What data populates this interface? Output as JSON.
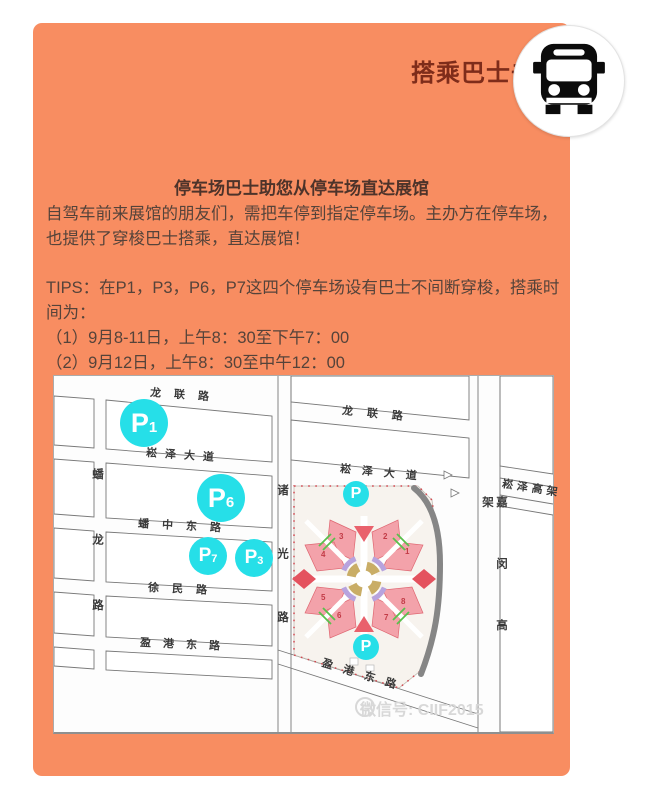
{
  "card": {
    "title": "搭乘巴士去展馆"
  },
  "intro": {
    "heading": "停车场巴士助您从停车场直达展馆",
    "line1": "自驾车前来展馆的朋友们，需把车停到指定停车场。主办方在停车场，",
    "line2": "也提供了穿梭巴士搭乘，直达展馆！"
  },
  "tips": {
    "line1": "TIPS：在P1，P3，P6，P7这四个停车场设有巴士不间断穿梭，搭乘时",
    "line2": "间为：",
    "item1": "（1）9月8-11日，上午8：30至下午7：00",
    "item2": "（2）9月12日，上午8：30至中午12：00"
  },
  "map": {
    "roads": {
      "longlian_w": "龙联路",
      "longlian_e": "龙联路",
      "songze_ave_w": "崧泽大道",
      "songze_ave_e": "崧泽大道",
      "panzhong_rd": "蟠中东路",
      "xumin_rd": "徐民路",
      "yinggang_w": "盈港东路",
      "yinggang_diag": "盈港东路",
      "songze_viaduct": "崧泽高架",
      "panlong_rd": "蟠龙路",
      "zhuguang_rd": "诸光路",
      "jiamin_viaduct": "嘉闵高架"
    },
    "parking": {
      "p1": {
        "p": "P",
        "n": "1"
      },
      "p6": {
        "p": "P",
        "n": "6"
      },
      "p7": {
        "p": "P",
        "n": "7"
      },
      "p3": {
        "p": "P",
        "n": "3"
      },
      "venue_top": {
        "p": "P"
      },
      "venue_bottom": {
        "p": "P"
      }
    },
    "halls": [
      "1",
      "2",
      "3",
      "4",
      "5",
      "6",
      "7",
      "8"
    ],
    "watermark": "微信号: CIIF2015"
  },
  "icons": {
    "badge": "bus-icon",
    "watermark": "wechat-logo-icon"
  },
  "colors": {
    "card_bg": "#f88d61",
    "title_text": "#7e2c1a",
    "body_text": "#55433a",
    "parking_cyan": "#26dfe8",
    "venue_pink": "#f3a2aa",
    "venue_red": "#e4525e",
    "venue_gold": "#c9ad66"
  }
}
